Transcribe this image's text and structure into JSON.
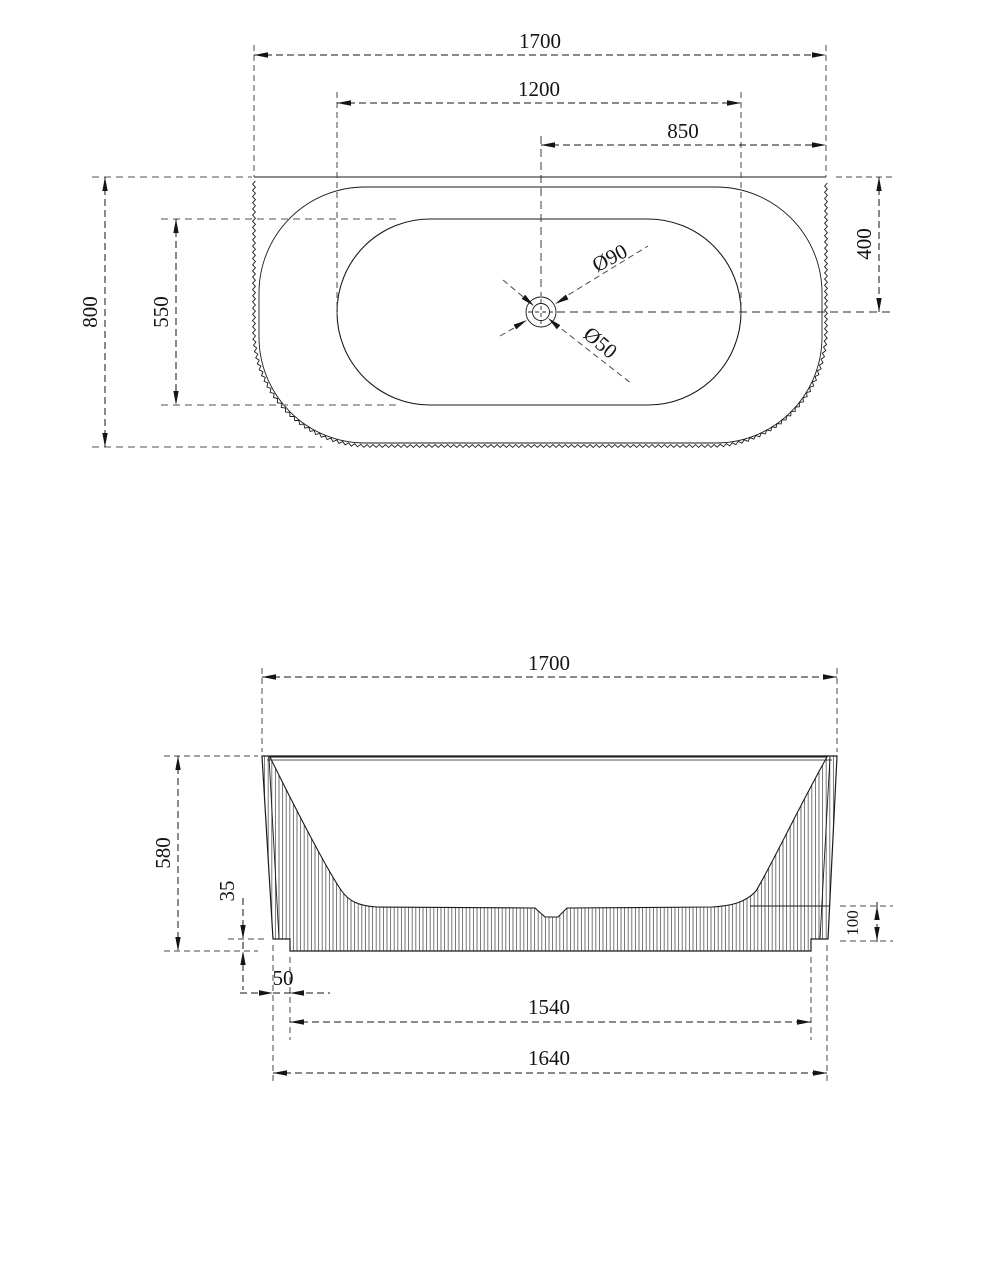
{
  "drawing": {
    "top_view": {
      "overall_width": "1700",
      "basin_length": "1200",
      "drain_offset_right": "850",
      "overall_depth": "800",
      "basin_depth": "550",
      "drain_offset_back": "400",
      "drain_outer_dia": "Ø90",
      "drain_inner_dia": "Ø50"
    },
    "side_view": {
      "overall_width": "1700",
      "overall_height": "580",
      "base_step_height": "35",
      "wall_base_height": "100",
      "base_inset": "50",
      "base_bottom_width": "1540",
      "body_bottom_width": "1640"
    },
    "colors": {
      "line": "#1a1a1a",
      "extension_line": "#757575",
      "background": "#ffffff"
    }
  }
}
